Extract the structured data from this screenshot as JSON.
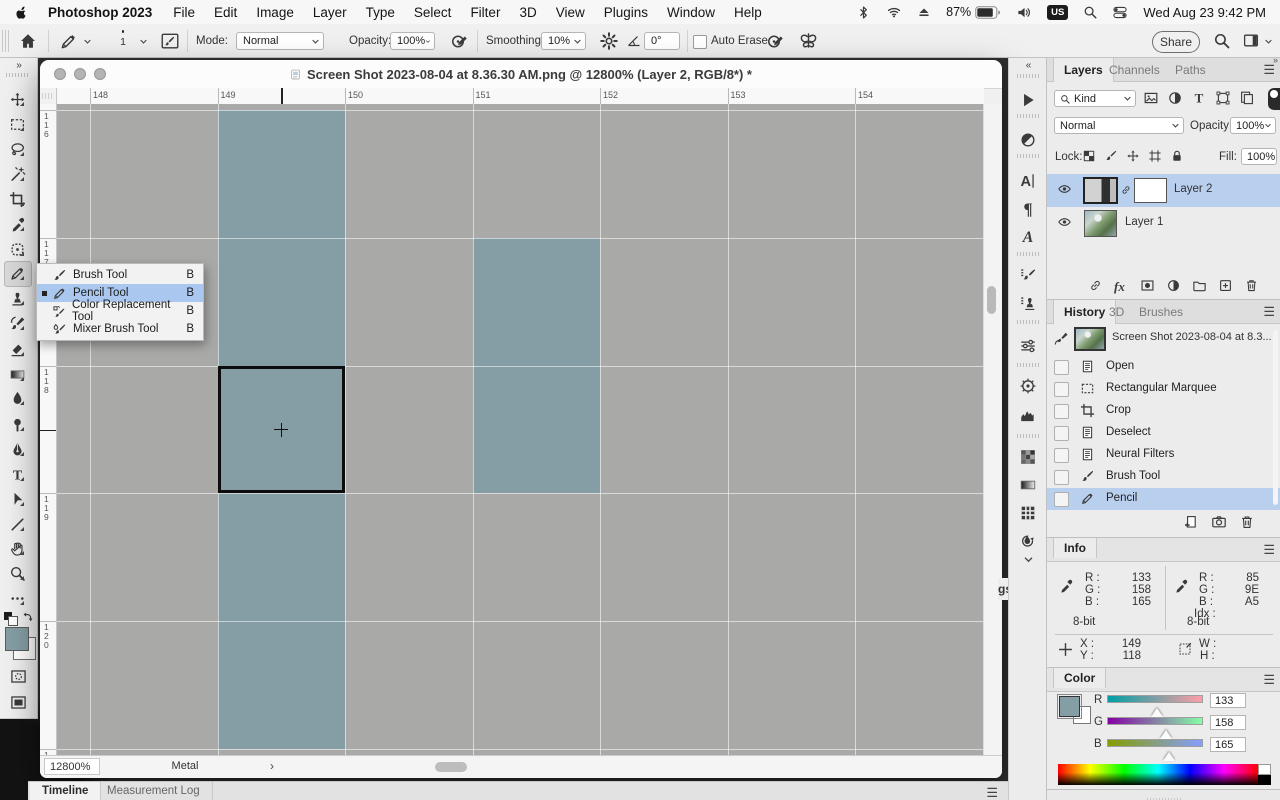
{
  "menu_bar": {
    "app_name": "Photoshop 2023",
    "menus": [
      "File",
      "Edit",
      "Image",
      "Layer",
      "Type",
      "Select",
      "Filter",
      "3D",
      "View",
      "Plugins",
      "Window",
      "Help"
    ],
    "battery": "87%",
    "input_source": "US",
    "clock": "Wed Aug 23  9:42 PM"
  },
  "options_bar": {
    "brush_size": "1",
    "mode_label": "Mode:",
    "mode_value": "Normal",
    "opacity_label": "Opacity:",
    "opacity_value": "100%",
    "smoothing_label": "Smoothing:",
    "smoothing_value": "10%",
    "angle_value": "0°",
    "auto_erase_label": "Auto Erase",
    "share_label": "Share"
  },
  "toolbar": {
    "tools": [
      "move",
      "rectangular-marquee",
      "lasso",
      "object-selection",
      "crop",
      "eyedropper",
      "spot-healing-brush",
      "pencil",
      "clone-stamp",
      "history-brush",
      "eraser",
      "gradient",
      "blur",
      "dodge",
      "pen",
      "type",
      "path-selection",
      "line",
      "hand",
      "zoom",
      "edit-toolbar"
    ],
    "selected_tool": "pencil",
    "foreground_color": "#859EA5",
    "background_color": "#FFFFFF"
  },
  "tool_flyout": {
    "items": [
      {
        "label": "Brush Tool",
        "shortcut": "B",
        "icon": "brush",
        "selected": false
      },
      {
        "label": "Pencil Tool",
        "shortcut": "B",
        "icon": "pencil",
        "selected": true
      },
      {
        "label": "Color Replacement Tool",
        "shortcut": "B",
        "icon": "color-replace",
        "selected": false
      },
      {
        "label": "Mixer Brush Tool",
        "shortcut": "B",
        "icon": "mixer-brush",
        "selected": false
      }
    ]
  },
  "document": {
    "title": "Screen Shot 2023-08-04 at 8.36.30 AM.png @ 12800% (Layer 2, RGB/8*) *",
    "h_ruler": [
      "148",
      "149",
      "150",
      "151",
      "152",
      "153",
      "154"
    ],
    "v_ruler": [
      "116",
      "117",
      "118",
      "119",
      "120",
      "121"
    ],
    "status": {
      "zoom": "12800%",
      "gpu": "Metal"
    },
    "canvas": {
      "gray": "#a9aaa8",
      "teal": "#859ea5",
      "teal_cells": [
        {
          "col": 149,
          "row": 116
        },
        {
          "col": 149,
          "row": 117
        },
        {
          "col": 149,
          "row": 118
        },
        {
          "col": 149,
          "row": 119
        },
        {
          "col": 149,
          "row": 120
        },
        {
          "col": 151,
          "row": 117
        },
        {
          "col": 151,
          "row": 118
        }
      ],
      "selection": {
        "col": 149,
        "row": 118
      },
      "cursor": {
        "col": 149,
        "row": 118
      }
    }
  },
  "dock_strip": {
    "icons": [
      "actions",
      "adjustments-half",
      "character",
      "paragraph",
      "glyphs",
      "brush-settings",
      "clone-source",
      "adjustments",
      "navigator",
      "histogram",
      "swatches",
      "gradients",
      "patterns",
      "styles"
    ]
  },
  "panels": {
    "layers": {
      "tabs": [
        "Layers",
        "Channels",
        "Paths"
      ],
      "active_tab": "Layers",
      "kind_label": "Kind",
      "filter_icons": [
        "pixel-layers-filter",
        "adjustment-layers-filter",
        "type-layers-filter",
        "shape-layers-filter",
        "smart-objects-filter"
      ],
      "blend_mode": "Normal",
      "opacity_label": "Opacity:",
      "opacity_value": "100%",
      "lock_label": "Lock:",
      "lock_icons": [
        "lock-transparency",
        "lock-pixels",
        "lock-position",
        "lock-artboard",
        "lock-all"
      ],
      "fill_label": "Fill:",
      "fill_value": "100%",
      "layers": [
        {
          "name": "Layer 2",
          "selected": true,
          "has_mask": true
        },
        {
          "name": "Layer 1",
          "selected": false,
          "has_mask": false
        }
      ],
      "actions": [
        "link-layers",
        "layer-effects",
        "add-layer-mask",
        "new-adjustment-layer",
        "new-group",
        "new-layer",
        "delete-layer"
      ]
    },
    "history": {
      "tabs": [
        "History",
        "3D",
        "Brushes"
      ],
      "active_tab": "History",
      "snapshot_name": "Screen Shot 2023-08-04 at 8.3...",
      "items": [
        {
          "label": "Open",
          "icon": "doc",
          "selected": false
        },
        {
          "label": "Rectangular Marquee",
          "icon": "marquee-sm",
          "selected": false
        },
        {
          "label": "Crop",
          "icon": "crop-sm",
          "selected": false
        },
        {
          "label": "Deselect",
          "icon": "doc",
          "selected": false
        },
        {
          "label": "Neural Filters",
          "icon": "doc",
          "selected": false
        },
        {
          "label": "Brush Tool",
          "icon": "brush",
          "selected": false
        },
        {
          "label": "Pencil",
          "icon": "pencil",
          "selected": true
        }
      ],
      "actions": [
        "new-doc-from-state",
        "new-snapshot",
        "delete-state"
      ]
    },
    "info": {
      "tab": "Info",
      "labels": {
        "r": "R :",
        "g": "G :",
        "b": "B :",
        "idx": "Idx :",
        "x": "X :",
        "y": "Y :",
        "w": "W :",
        "h": "H :"
      },
      "left": {
        "r": "133",
        "g": "158",
        "b": "165",
        "depth": "8-bit"
      },
      "right": {
        "r": "85",
        "g": "9E",
        "b": "A5",
        "idx": "",
        "depth": "8-bit"
      },
      "x": "149",
      "y": "118",
      "w": "",
      "h": ""
    },
    "color": {
      "tab": "Color",
      "labels": {
        "r": "R",
        "g": "G",
        "b": "B"
      },
      "r": 133,
      "g": 158,
      "b": 165,
      "foreground": "#859EA5",
      "background": "#FFFFFF"
    }
  },
  "bottom_bar": {
    "tabs": [
      "Timeline",
      "Measurement Log"
    ],
    "active_tab": "Timeline"
  },
  "fragment_text": "gs"
}
